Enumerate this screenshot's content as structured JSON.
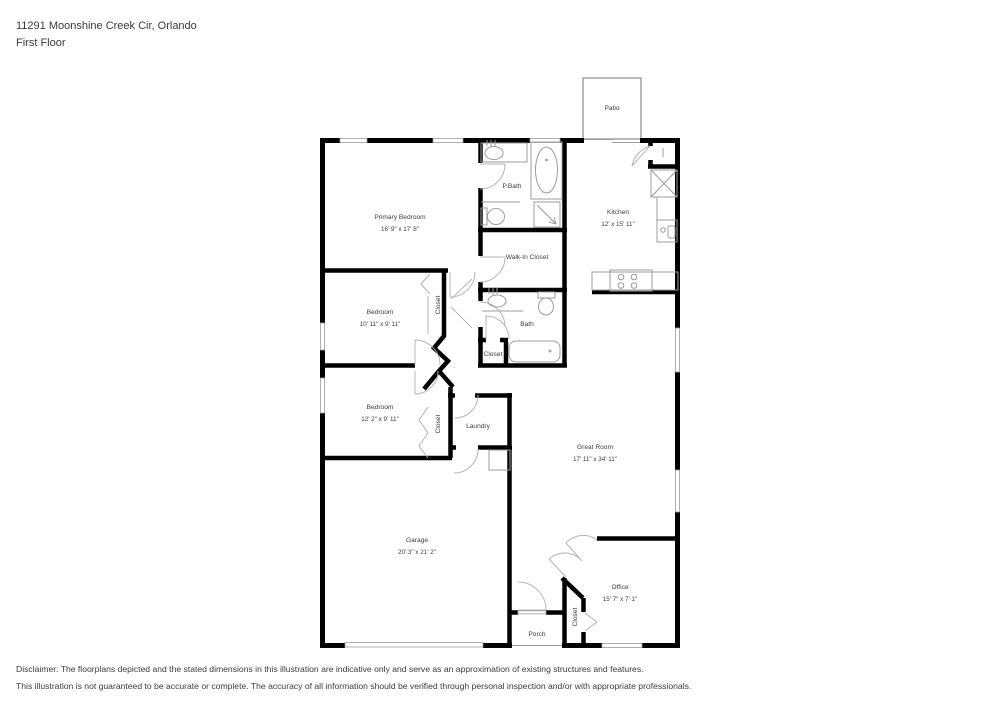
{
  "header": {
    "address_line": "11291 Moonshine Creek Cir, Orlando",
    "floor_line": "First Floor"
  },
  "rooms": {
    "patio": {
      "name": "Patio"
    },
    "primary_bedroom": {
      "name": "Primary Bedroom",
      "dims": "16' 9\" x 17' 8\""
    },
    "p_bath": {
      "name": "P.Bath"
    },
    "walk_in_closet": {
      "name": "Walk-In Closet"
    },
    "kitchen": {
      "name": "Kitchen",
      "dims": "12' x 15' 11\""
    },
    "bedroom_2": {
      "name": "Bedroom",
      "dims": "10' 11\" x 9' 11\""
    },
    "bedroom_2_closet": {
      "name": "Closet"
    },
    "bath": {
      "name": "Bath"
    },
    "bath_closet": {
      "name": "Closet"
    },
    "bedroom_3": {
      "name": "Bedroom",
      "dims": "12' 2\" x 9' 11\""
    },
    "bedroom_3_closet": {
      "name": "Closet"
    },
    "laundry": {
      "name": "Laundry"
    },
    "great_room": {
      "name": "Great Room",
      "dims": "17' 11\" x 34' 11\""
    },
    "garage": {
      "name": "Garage",
      "dims": "20' 3\" x 21' 2\""
    },
    "office": {
      "name": "Office",
      "dims": "15' 7\" x 7' 1\""
    },
    "office_closet": {
      "name": "Closet"
    },
    "porch": {
      "name": "Porch"
    }
  },
  "disclaimer": {
    "line1": "Disclaimer: The floorplans depicted and the stated dimensions in this illustration are indicative only and serve as an approximation of existing structures and features.",
    "line2": "This illustration is not guaranteed to be accurate or complete. The accuracy of all information should be verified through personal inspection and/or with appropriate professionals."
  },
  "colors": {
    "wall": "#000000",
    "fixture": "#9c9c9c",
    "door": "#b4b4b4",
    "text": "#3b3b3b"
  }
}
